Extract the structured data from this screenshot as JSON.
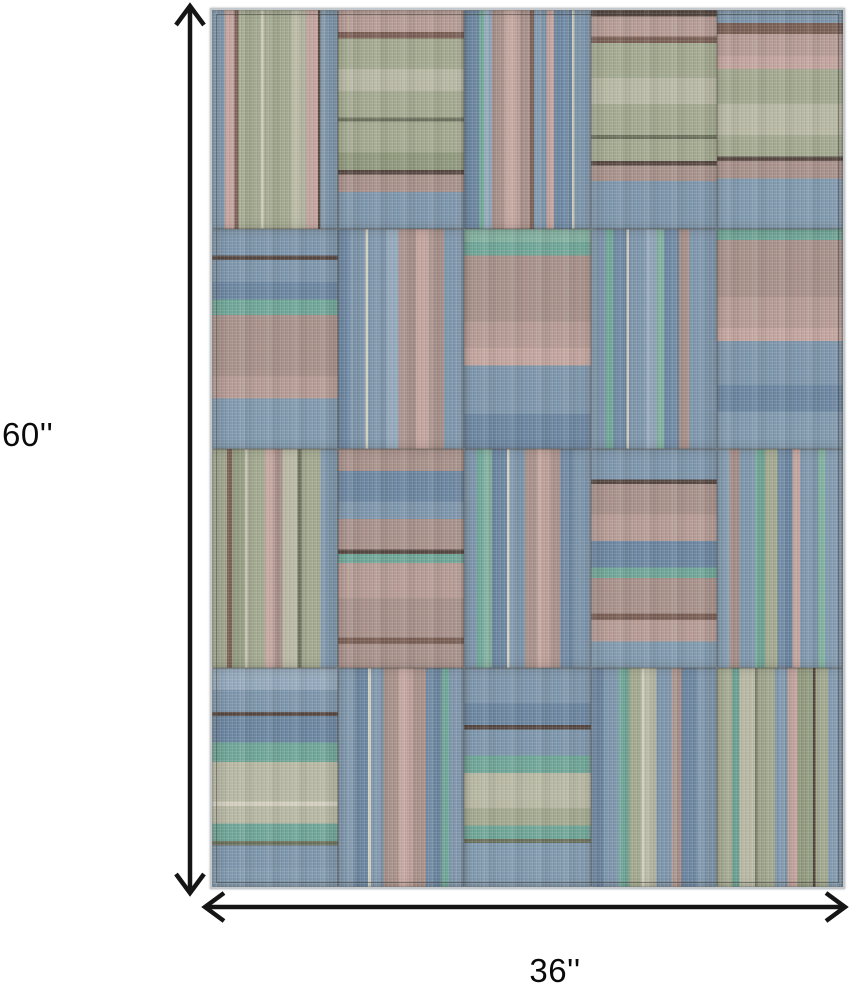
{
  "page": {
    "background": "#ffffff"
  },
  "dimensions": {
    "height_label": "60''",
    "width_label": "36''",
    "arrow_color": "#151515",
    "label_color": "#0a0a0a"
  },
  "rug": {
    "rows": 4,
    "cols": 5,
    "palette": {
      "B1": "#7d95ab",
      "B2": "#6c86a1",
      "B3": "#93a8bb",
      "B4": "#8099ae",
      "T1": "#6fa597",
      "T2": "#82b0a0",
      "S1": "#a2a88f",
      "S2": "#b7b7a3",
      "S3": "#8f987c",
      "O1": "#6b705c",
      "M1": "#a8908a",
      "M2": "#b59a94",
      "P1": "#c2a39d",
      "BR": "#7a5f55",
      "D1": "#564741",
      "C1": "#d2cfbf"
    },
    "patches": [
      {
        "o": "v",
        "s": [
          [
            "B4",
            10
          ],
          [
            "P1",
            8
          ],
          [
            "BR",
            3
          ],
          [
            "S1",
            18
          ],
          [
            "C1",
            2
          ],
          [
            "S1",
            22
          ],
          [
            "S2",
            12
          ],
          [
            "P1",
            9
          ],
          [
            "D1",
            2
          ],
          [
            "B1",
            14
          ]
        ]
      },
      {
        "o": "h",
        "s": [
          [
            "M2",
            10
          ],
          [
            "BR",
            3
          ],
          [
            "S1",
            14
          ],
          [
            "S2",
            10
          ],
          [
            "S1",
            12
          ],
          [
            "O1",
            2
          ],
          [
            "S1",
            14
          ],
          [
            "S3",
            8
          ],
          [
            "D1",
            2
          ],
          [
            "M1",
            8
          ],
          [
            "B1",
            17
          ]
        ]
      },
      {
        "o": "v",
        "s": [
          [
            "B2",
            12
          ],
          [
            "T1",
            4
          ],
          [
            "B3",
            6
          ],
          [
            "M1",
            10
          ],
          [
            "P1",
            12
          ],
          [
            "M1",
            8
          ],
          [
            "BR",
            3
          ],
          [
            "B1",
            10
          ],
          [
            "P1",
            6
          ],
          [
            "B2",
            14
          ],
          [
            "C1",
            2
          ],
          [
            "B1",
            13
          ]
        ]
      },
      {
        "o": "h",
        "s": [
          [
            "D1",
            3
          ],
          [
            "M2",
            9
          ],
          [
            "BR",
            3
          ],
          [
            "S1",
            16
          ],
          [
            "S2",
            12
          ],
          [
            "S1",
            14
          ],
          [
            "O1",
            2
          ],
          [
            "S1",
            10
          ],
          [
            "D1",
            2
          ],
          [
            "M1",
            7
          ],
          [
            "B1",
            22
          ]
        ]
      },
      {
        "o": "h",
        "s": [
          [
            "B1",
            6
          ],
          [
            "BR",
            5
          ],
          [
            "M2",
            10
          ],
          [
            "P1",
            6
          ],
          [
            "S1",
            16
          ],
          [
            "S2",
            14
          ],
          [
            "S1",
            10
          ],
          [
            "D1",
            2
          ],
          [
            "M1",
            8
          ],
          [
            "B4",
            23
          ]
        ]
      },
      {
        "o": "h",
        "s": [
          [
            "B1",
            12
          ],
          [
            "D1",
            2
          ],
          [
            "B1",
            10
          ],
          [
            "B2",
            8
          ],
          [
            "T1",
            7
          ],
          [
            "M1",
            28
          ],
          [
            "M2",
            10
          ],
          [
            "B4",
            23
          ]
        ]
      },
      {
        "o": "v",
        "s": [
          [
            "B2",
            10
          ],
          [
            "B1",
            12
          ],
          [
            "C1",
            2
          ],
          [
            "B1",
            14
          ],
          [
            "B3",
            10
          ],
          [
            "M1",
            14
          ],
          [
            "P1",
            10
          ],
          [
            "M1",
            12
          ],
          [
            "B1",
            16
          ]
        ]
      },
      {
        "o": "h",
        "s": [
          [
            "T2",
            6
          ],
          [
            "T1",
            6
          ],
          [
            "M1",
            30
          ],
          [
            "M2",
            12
          ],
          [
            "P1",
            8
          ],
          [
            "B1",
            22
          ],
          [
            "B2",
            16
          ]
        ]
      },
      {
        "o": "v",
        "s": [
          [
            "B1",
            12
          ],
          [
            "T1",
            6
          ],
          [
            "B2",
            10
          ],
          [
            "C1",
            2
          ],
          [
            "B1",
            14
          ],
          [
            "B3",
            8
          ],
          [
            "T2",
            6
          ],
          [
            "B2",
            12
          ],
          [
            "M1",
            8
          ],
          [
            "B1",
            22
          ]
        ]
      },
      {
        "o": "h",
        "s": [
          [
            "T1",
            5
          ],
          [
            "M1",
            26
          ],
          [
            "M2",
            14
          ],
          [
            "P1",
            6
          ],
          [
            "B1",
            20
          ],
          [
            "B2",
            12
          ],
          [
            "B4",
            17
          ]
        ]
      },
      {
        "o": "v",
        "s": [
          [
            "S1",
            12
          ],
          [
            "BR",
            4
          ],
          [
            "S3",
            10
          ],
          [
            "C1",
            2
          ],
          [
            "S1",
            14
          ],
          [
            "P1",
            8
          ],
          [
            "M1",
            6
          ],
          [
            "S2",
            12
          ],
          [
            "O1",
            3
          ],
          [
            "S1",
            15
          ],
          [
            "B1",
            14
          ]
        ]
      },
      {
        "o": "h",
        "s": [
          [
            "M1",
            10
          ],
          [
            "B2",
            14
          ],
          [
            "B1",
            8
          ],
          [
            "M1",
            14
          ],
          [
            "D1",
            2
          ],
          [
            "T1",
            4
          ],
          [
            "M2",
            16
          ],
          [
            "M1",
            18
          ],
          [
            "BR",
            3
          ],
          [
            "M1",
            11
          ]
        ]
      },
      {
        "o": "v",
        "s": [
          [
            "B1",
            10
          ],
          [
            "T1",
            6
          ],
          [
            "T2",
            6
          ],
          [
            "B2",
            12
          ],
          [
            "C1",
            2
          ],
          [
            "B1",
            12
          ],
          [
            "M1",
            10
          ],
          [
            "P1",
            10
          ],
          [
            "M1",
            8
          ],
          [
            "B2",
            10
          ],
          [
            "B1",
            14
          ]
        ]
      },
      {
        "o": "h",
        "s": [
          [
            "B1",
            14
          ],
          [
            "D1",
            2
          ],
          [
            "M1",
            14
          ],
          [
            "M2",
            12
          ],
          [
            "B2",
            12
          ],
          [
            "T1",
            5
          ],
          [
            "M1",
            16
          ],
          [
            "BR",
            3
          ],
          [
            "M2",
            10
          ],
          [
            "B4",
            12
          ]
        ]
      },
      {
        "o": "v",
        "s": [
          [
            "B4",
            10
          ],
          [
            "M1",
            8
          ],
          [
            "B1",
            12
          ],
          [
            "T1",
            8
          ],
          [
            "S1",
            10
          ],
          [
            "B2",
            12
          ],
          [
            "P1",
            6
          ],
          [
            "B1",
            14
          ],
          [
            "T2",
            6
          ],
          [
            "B4",
            14
          ]
        ]
      },
      {
        "o": "h",
        "s": [
          [
            "B3",
            10
          ],
          [
            "B1",
            10
          ],
          [
            "D1",
            2
          ],
          [
            "B2",
            12
          ],
          [
            "T1",
            9
          ],
          [
            "S2",
            18
          ],
          [
            "C1",
            2
          ],
          [
            "S2",
            8
          ],
          [
            "T1",
            8
          ],
          [
            "O1",
            2
          ],
          [
            "B1",
            10
          ],
          [
            "B4",
            9
          ]
        ]
      },
      {
        "o": "v",
        "s": [
          [
            "B1",
            14
          ],
          [
            "B2",
            10
          ],
          [
            "C1",
            2
          ],
          [
            "B1",
            10
          ],
          [
            "M1",
            12
          ],
          [
            "P1",
            12
          ],
          [
            "M1",
            10
          ],
          [
            "B2",
            12
          ],
          [
            "T1",
            6
          ],
          [
            "B1",
            12
          ]
        ]
      },
      {
        "o": "h",
        "s": [
          [
            "B1",
            16
          ],
          [
            "B2",
            10
          ],
          [
            "D1",
            2
          ],
          [
            "B1",
            12
          ],
          [
            "T1",
            8
          ],
          [
            "S2",
            16
          ],
          [
            "S1",
            8
          ],
          [
            "T1",
            6
          ],
          [
            "O1",
            2
          ],
          [
            "B4",
            20
          ]
        ]
      },
      {
        "o": "v",
        "s": [
          [
            "B2",
            10
          ],
          [
            "B1",
            12
          ],
          [
            "T1",
            8
          ],
          [
            "S1",
            10
          ],
          [
            "C1",
            2
          ],
          [
            "S2",
            10
          ],
          [
            "B1",
            12
          ],
          [
            "M1",
            8
          ],
          [
            "B2",
            12
          ],
          [
            "B1",
            16
          ]
        ]
      },
      {
        "o": "v",
        "s": [
          [
            "S1",
            12
          ],
          [
            "T1",
            6
          ],
          [
            "S2",
            12
          ],
          [
            "O1",
            2
          ],
          [
            "S1",
            14
          ],
          [
            "B1",
            10
          ],
          [
            "P1",
            8
          ],
          [
            "S3",
            12
          ],
          [
            "D1",
            2
          ],
          [
            "S1",
            10
          ],
          [
            "B4",
            12
          ]
        ]
      }
    ]
  }
}
